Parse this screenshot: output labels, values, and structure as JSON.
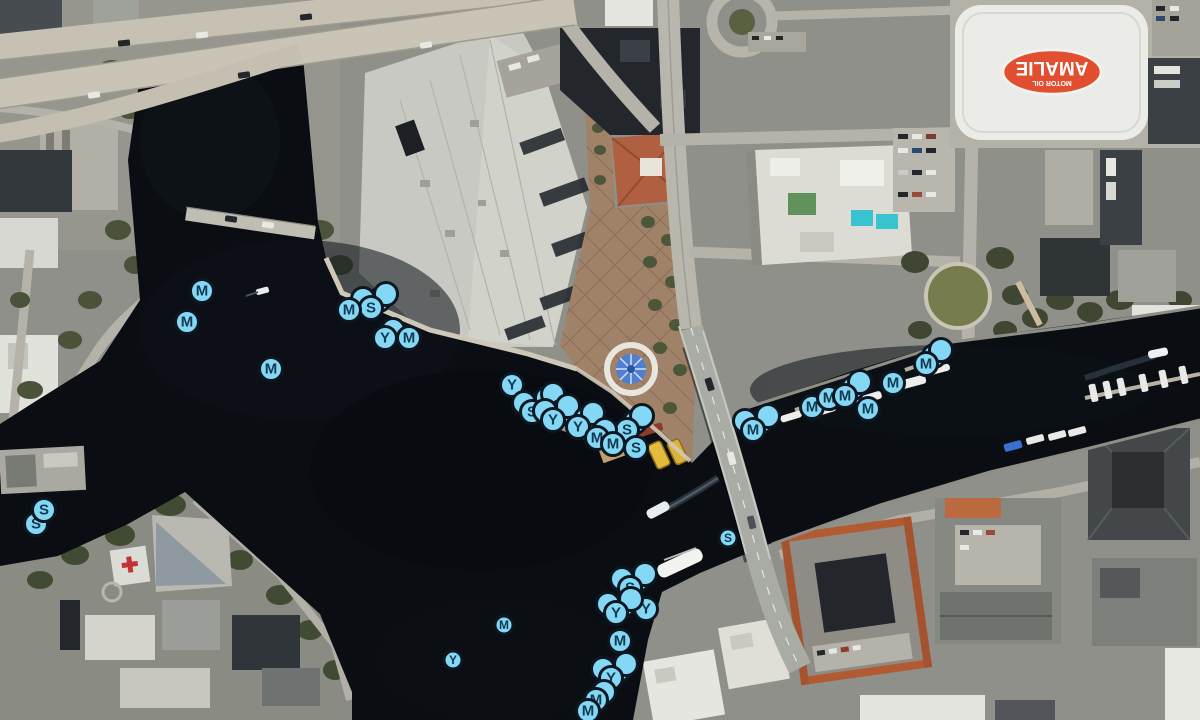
{
  "map": {
    "description": "Aerial satellite boating map of downtown Tampa riverfront with mooring, slip and yacht-club markers",
    "arena_logo": {
      "brand": "AMALIE",
      "sub": "MOTOR OIL"
    },
    "hospital_helipad_symbol": "+",
    "marker_style": {
      "fill": "#85d8f5",
      "ring": "#0d1722",
      "text_color": "#113950",
      "default_size": 26,
      "small_size": 21
    },
    "stack_offsets": [
      [
        8,
        -8
      ],
      [
        15,
        -14
      ],
      [
        -8,
        -9
      ],
      [
        21,
        -18
      ]
    ],
    "markers": [
      {
        "letter": "M",
        "x": 202,
        "y": 291
      },
      {
        "letter": "M",
        "x": 187,
        "y": 322
      },
      {
        "letter": "M",
        "x": 271,
        "y": 369
      },
      {
        "letter": "S",
        "x": 36,
        "y": 524
      },
      {
        "letter": "S",
        "x": 44,
        "y": 510
      },
      {
        "letter": "S",
        "x": 371,
        "y": 308,
        "stack": 3
      },
      {
        "letter": "M",
        "x": 349,
        "y": 310
      },
      {
        "letter": "Y",
        "x": 385,
        "y": 338,
        "stack": 1
      },
      {
        "letter": "M",
        "x": 409,
        "y": 338
      },
      {
        "letter": "Y",
        "x": 512,
        "y": 385
      },
      {
        "letter": "S",
        "x": 532,
        "y": 412,
        "stack": 4
      },
      {
        "letter": "Y",
        "x": 553,
        "y": 420,
        "stack": 3
      },
      {
        "letter": "Y",
        "x": 578,
        "y": 427,
        "stack": 2
      },
      {
        "letter": "S",
        "x": 627,
        "y": 430,
        "stack": 2
      },
      {
        "letter": "M",
        "x": 597,
        "y": 438,
        "stack": 1
      },
      {
        "letter": "M",
        "x": 613,
        "y": 444
      },
      {
        "letter": "S",
        "x": 636,
        "y": 448
      },
      {
        "letter": "M",
        "x": 753,
        "y": 430,
        "stack": 3
      },
      {
        "letter": "M",
        "x": 812,
        "y": 407
      },
      {
        "letter": "M",
        "x": 829,
        "y": 398
      },
      {
        "letter": "M",
        "x": 845,
        "y": 396,
        "stack": 2
      },
      {
        "letter": "M",
        "x": 868,
        "y": 409
      },
      {
        "letter": "M",
        "x": 893,
        "y": 383
      },
      {
        "letter": "M",
        "x": 926,
        "y": 364,
        "stack": 2
      },
      {
        "letter": "S",
        "x": 728,
        "y": 538,
        "size": 21
      },
      {
        "letter": "S",
        "x": 630,
        "y": 588,
        "stack": 3
      },
      {
        "letter": "Y",
        "x": 646,
        "y": 609
      },
      {
        "letter": "Y",
        "x": 616,
        "y": 613,
        "stack": 3
      },
      {
        "letter": "M",
        "x": 620,
        "y": 641
      },
      {
        "letter": "Y",
        "x": 611,
        "y": 678,
        "stack": 3
      },
      {
        "letter": "M",
        "x": 596,
        "y": 700,
        "stack": 1
      },
      {
        "letter": "M",
        "x": 588,
        "y": 711
      },
      {
        "letter": "M",
        "x": 504,
        "y": 625,
        "size": 21
      },
      {
        "letter": "Y",
        "x": 453,
        "y": 660,
        "size": 21
      }
    ]
  }
}
